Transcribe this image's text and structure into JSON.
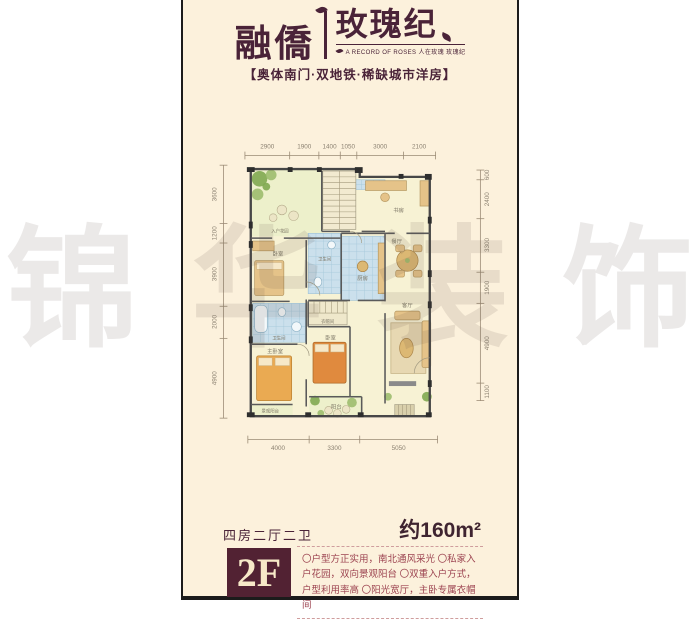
{
  "brand": {
    "name_left": "融僑",
    "name_right": "玫瑰纪",
    "subtitle": "A RECORD OF ROSES 人在玫瑰 玫瑰纪",
    "tagline": "【奥体南门·双地铁·稀缺城市洋房】",
    "color": "#4a2338"
  },
  "watermark": {
    "chars": [
      "锦",
      "华",
      "装",
      "饰"
    ]
  },
  "floorplan": {
    "dims_top": [
      "2900",
      "1900",
      "1400",
      "1050",
      "3000",
      "2100"
    ],
    "dims_left": [
      "3600",
      "1200",
      "3900",
      "2000",
      "4900"
    ],
    "dims_right": [
      "600",
      "2400",
      "3300",
      "1900",
      "4900",
      "1100"
    ],
    "dims_bottom": [
      "4000",
      "3300",
      "5050"
    ],
    "rooms": {
      "entry_garden": "入户花园",
      "study": "书房",
      "bedroom1": "卧室",
      "bath1": "卫生间",
      "kitchen": "厨房",
      "closet": "衣帽间",
      "bath2": "卫生间",
      "master": "主卧室",
      "bedroom2": "卧室",
      "dining": "餐厅",
      "living": "客厅",
      "balcony": "阳台",
      "view_balcony": "景观阳台"
    }
  },
  "info": {
    "layout_label": "四房二厅二卫",
    "area_label": "约160m²",
    "floor_badge": "2F",
    "description": "〇户型方正实用，南北通风采光 〇私家入户花园，双向景观阳台 〇双重入户方式，户型利用率高 〇阳光宽厅，主卧专属衣帽间"
  }
}
